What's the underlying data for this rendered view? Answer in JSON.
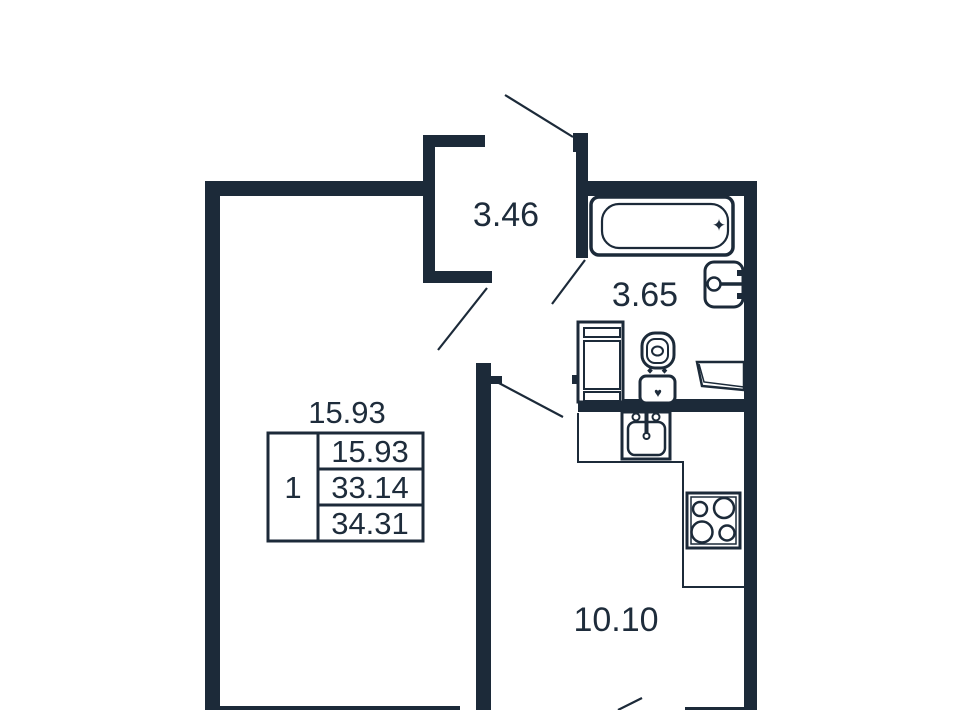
{
  "colors": {
    "wall": "#1c2a39",
    "text": "#1e2c3b",
    "background": "#ffffff"
  },
  "rooms": [
    {
      "name": "hallway",
      "area": "3.46"
    },
    {
      "name": "bathroom",
      "area": "3.65"
    },
    {
      "name": "kitchen",
      "area": "10.10"
    },
    {
      "name": "living-room",
      "area": "15.93"
    }
  ],
  "info_table": {
    "caption": "15.93",
    "room_count": "1",
    "rows": [
      "15.93",
      "33.14",
      "34.31"
    ]
  },
  "icons": {
    "bathtub_faucet": "✦",
    "toilet_tank_mark": "♥"
  }
}
